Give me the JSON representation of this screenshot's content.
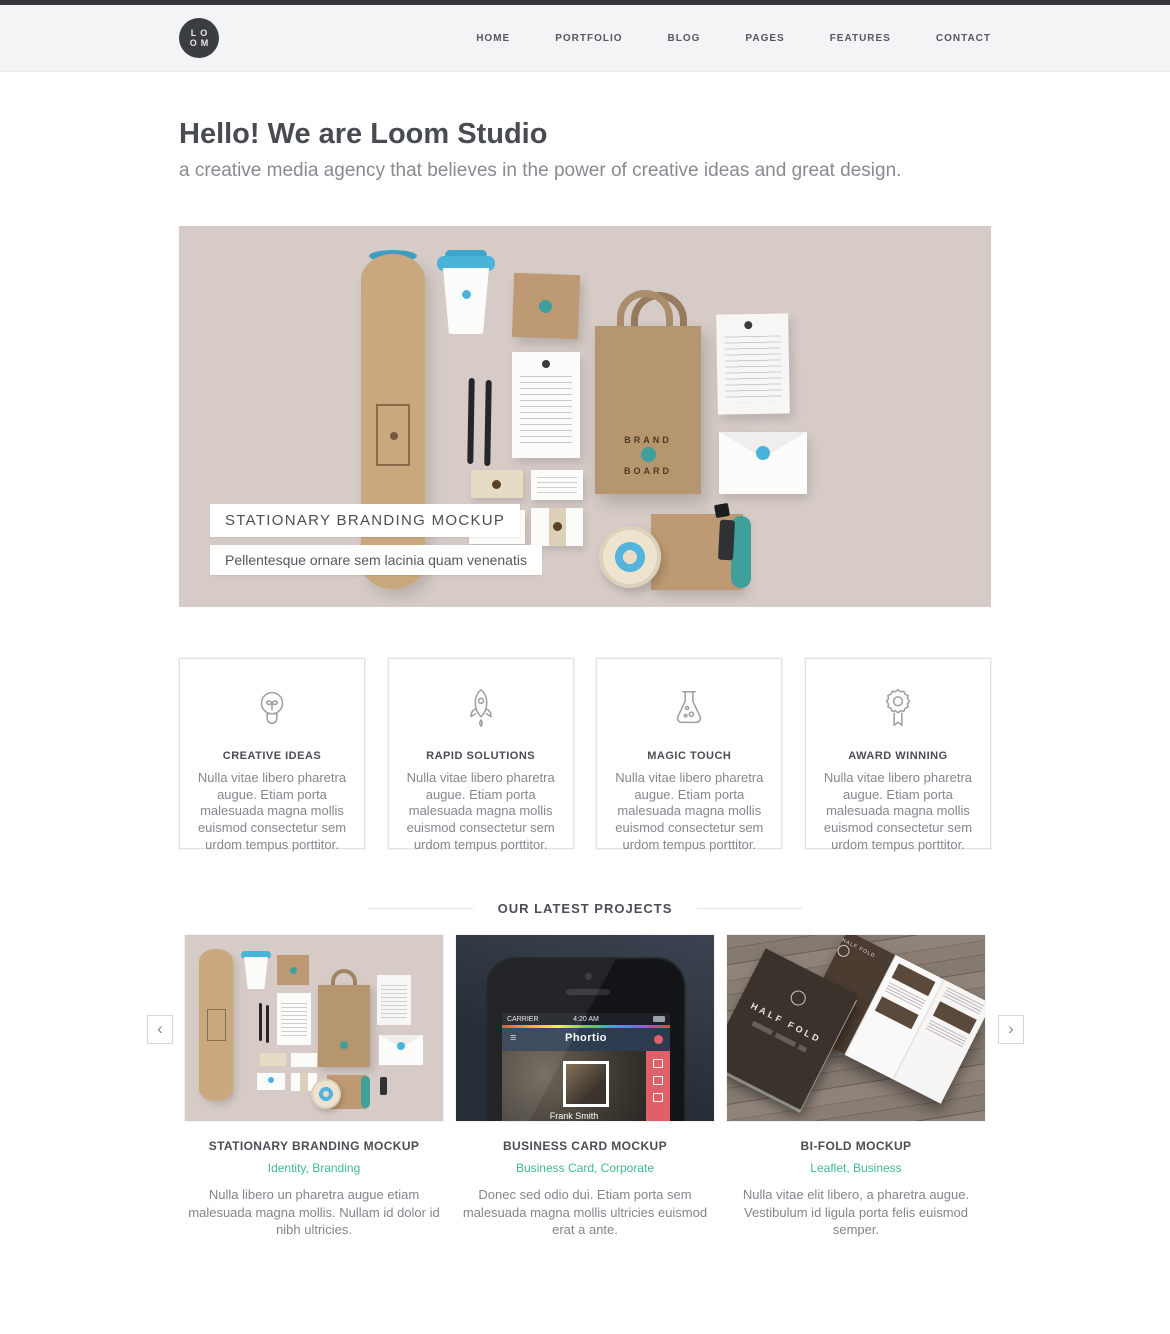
{
  "header": {
    "logo_top": "LO",
    "logo_bottom": "OM",
    "nav": [
      {
        "label": "HOME"
      },
      {
        "label": "PORTFOLIO"
      },
      {
        "label": "BLOG"
      },
      {
        "label": "PAGES"
      },
      {
        "label": "FEATURES"
      },
      {
        "label": "CONTACT"
      }
    ]
  },
  "intro": {
    "title": "Hello! We are Loom Studio",
    "subtitle": "a creative media agency that believes in the power of creative ideas and great design."
  },
  "hero": {
    "label_title": "STATIONARY BRANDING MOCKUP",
    "label_caption": "Pellentesque ornare sem lacinia quam venenatis",
    "brand_top": "BRAND",
    "brand_bottom": "BOARD"
  },
  "features": [
    {
      "icon": "lightbulb-icon",
      "title": "CREATIVE IDEAS",
      "text": "Nulla vitae libero pharetra augue. Etiam porta malesuada magna mollis euismod consectetur sem urdom tempus porttitor."
    },
    {
      "icon": "rocket-icon",
      "title": "RAPID SOLUTIONS",
      "text": "Nulla vitae libero pharetra augue. Etiam porta malesuada magna mollis euismod consectetur sem urdom tempus porttitor."
    },
    {
      "icon": "flask-icon",
      "title": "MAGIC TOUCH",
      "text": "Nulla vitae libero pharetra augue. Etiam porta malesuada magna mollis euismod consectetur sem urdom tempus porttitor."
    },
    {
      "icon": "award-icon",
      "title": "AWARD WINNING",
      "text": "Nulla vitae libero pharetra augue. Etiam porta malesuada magna mollis euismod consectetur sem urdom tempus porttitor."
    }
  ],
  "projects": {
    "heading": "OUR LATEST PROJECTS",
    "prev_icon": "‹",
    "next_icon": "›",
    "items": [
      {
        "title": "STATIONARY BRANDING MOCKUP",
        "categories": "Identity, Branding",
        "description": "Nulla libero un pharetra augue etiam malesuada magna mollis. Nullam id dolor id nibh ultricies."
      },
      {
        "title": "BUSINESS CARD MOCKUP",
        "categories": "Business Card, Corporate",
        "description": "Donec sed odio dui. Etiam porta sem malesuada magna mollis ultricies euismod erat a ante."
      },
      {
        "title": "BI-FOLD MOCKUP",
        "categories": "Leaflet, Business",
        "description": "Nulla vitae elit libero, a pharetra augue. Vestibulum id ligula porta felis euismod semper."
      }
    ],
    "phone_screen": {
      "menu_icon": "≡",
      "carrier": "CARRIER",
      "time": "4:20 AM",
      "app_name": "Phortio",
      "contact_name": "Frank Smith"
    },
    "brochure_title": "HALF FOLD"
  },
  "colors": {
    "accent_green": "#41b995",
    "hero_background": "#d6cbc7",
    "kraft": "#c2a17b",
    "sky_blue": "#49b4da",
    "teal": "#3f9f9b",
    "phone_card_background": "#2d3540",
    "red_sidebar": "#e0606a",
    "topbar_dark": "#34373b"
  }
}
